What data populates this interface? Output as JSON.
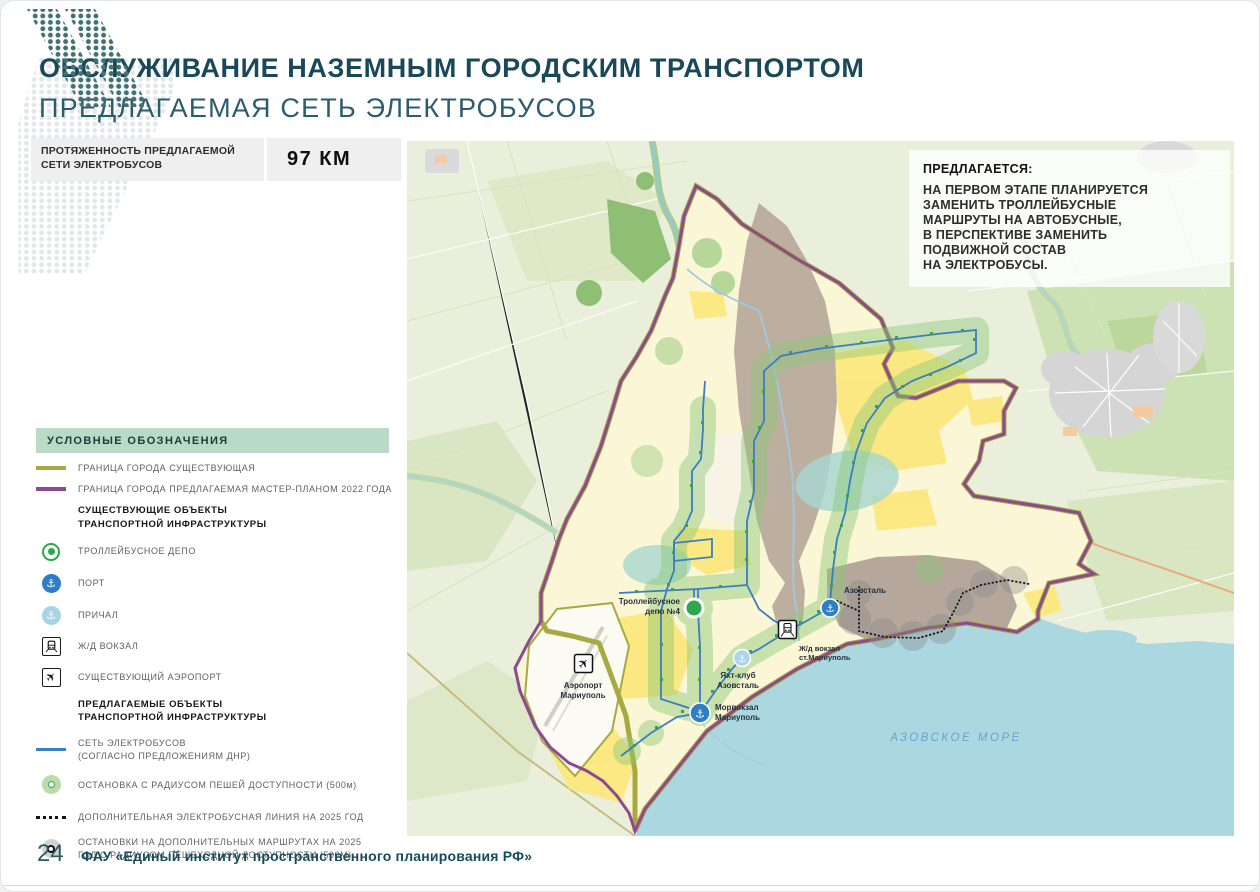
{
  "header": {
    "title": "ОБСЛУЖИВАНИЕ НАЗЕМНЫМ ГОРОДСКИМ ТРАНСПОРТОМ",
    "subtitle": "ПРЕДЛАГАЕМАЯ СЕТЬ ЭЛЕКТРОБУСОВ"
  },
  "stat": {
    "label": "ПРОТЯЖЕННОСТЬ ПРЕДЛАГАЕМОЙ\nСЕТИ ЭЛЕКТРОБУСОВ",
    "value": "97 КМ"
  },
  "legend": {
    "title": "УСЛОВНЫЕ ОБОЗНАЧЕНИЯ",
    "items": [
      {
        "type": "line-existing",
        "label": "ГРАНИЦА ГОРОДА СУЩЕСТВУЮЩАЯ"
      },
      {
        "type": "line-proposed",
        "label": "ГРАНИЦА ГОРОДА ПРЕДЛАГАЕМАЯ МАСТЕР-ПЛАНОМ 2022 ГОДА"
      },
      {
        "type": "subheader",
        "label": "СУЩЕСТВУЮЩИЕ ОБЪЕКТЫ\nТРАНСПОРТНОЙ ИНФРАСТРУКТУРЫ"
      },
      {
        "type": "depot",
        "label": "ТРОЛЛЕЙБУСНОЕ ДЕПО"
      },
      {
        "type": "port",
        "label": "ПОРТ"
      },
      {
        "type": "pier",
        "label": "ПРИЧАЛ"
      },
      {
        "type": "rail",
        "label": "Ж/Д ВОКЗАЛ"
      },
      {
        "type": "airport",
        "label": "СУЩЕСТВУЮЩИЙ АЭРОПОРТ"
      },
      {
        "type": "subheader",
        "label": "ПРЕДЛАГАЕМЫЕ ОБЪЕКТЫ\nТРАНСПОРТНОЙ ИНФРАСТРУКТУРЫ"
      },
      {
        "type": "line-network",
        "label": "СЕТЬ ЭЛЕКТРОБУСОВ\n(СОГЛАСНО ПРЕДЛОЖЕНИЯМ ДНР)"
      },
      {
        "type": "stop",
        "label": "ОСТАНОВКА С РАДИУСОМ ПЕШЕЙ ДОСТУПНОСТИ (500м)"
      },
      {
        "type": "line-dotted",
        "label": "ДОПОЛНИТЕЛЬНАЯ ЭЛЕКТРОБУСНАЯ ЛИНИЯ НА 2025 ГОД"
      },
      {
        "type": "stop-2025",
        "label": "ОСТАНОВКИ НА ДОПОЛНИТЕЛЬНЫХ МАРШРУТАХ НА 2025\nГОД С РАДИУСОМ ПЕШЕХОДНОЙ ДОСТУПНОСТИ (500М)"
      }
    ]
  },
  "map_note": {
    "title": "ПРЕДЛАГАЕТСЯ:",
    "body": "НА ПЕРВОМ ЭТАПЕ ПЛАНИРУЕТСЯ\nЗАМЕНИТЬ ТРОЛЛЕЙБУСНЫЕ\nМАРШРУТЫ НА АВТОБУСНЫЕ,\nВ ПЕРСПЕКТИВЕ ЗАМЕНИТЬ\nПОДВИЖНОЙ СОСТАВ\nНА ЭЛЕКТРОБУСЫ."
  },
  "map": {
    "labels": {
      "depot_line1": "Троллейбусное",
      "depot_line2": "депо №4",
      "airport_line1": "Аэропорт",
      "airport_line2": "Мариуполь",
      "yacht_line1": "Яхт-клуб",
      "yacht_line2": "Азовсталь",
      "seaport_line1": "Морвокзал",
      "seaport_line2": "Мариуполь",
      "azovstal": "Азовсталь",
      "rail_line1": "Ж/д вокзал",
      "rail_line2": "ст.Мариуполь",
      "sea": "АЗОВСКОЕ МОРЕ"
    }
  },
  "footer": {
    "page": "24",
    "org": "ФАУ «Единый институт пространственного планирования РФ»"
  },
  "colors": {
    "accent_teal": "#19485a",
    "legend_header_bg": "#b9dac7",
    "boundary_existing": "#a8a943",
    "boundary_proposed": "#8d4b8f",
    "electrobus_network": "#3b80c2",
    "stop_radius_green": "#8cc878",
    "port_blue": "#2d7ec2",
    "pier_blue": "#a9d4e6",
    "sea_fill": "#abd7e0",
    "sea_label_blue": "#68a2cf"
  }
}
